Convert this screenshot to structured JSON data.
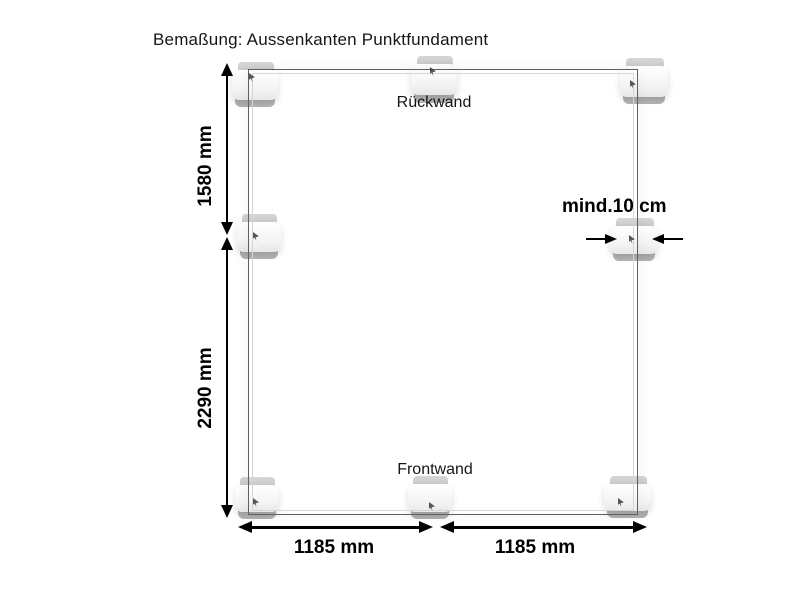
{
  "title": "Bemaßung: Aussenkanten Punktfundament",
  "labels": {
    "back_wall": "Rückwand",
    "front_wall": "Frontwand"
  },
  "dimensions": {
    "depth_upper": "1580 mm",
    "depth_lower": "2290 mm",
    "width_left": "1185 mm",
    "width_right": "1185 mm",
    "block_clearance": "mind.10 cm"
  },
  "diagram": {
    "type": "foundation-plan",
    "foundation_block_count": 8,
    "values_mm": {
      "depth_upper": 1580,
      "depth_lower": 2290,
      "width_left": 1185,
      "width_right": 1185,
      "minimum_block_clearance_cm": 10
    }
  },
  "colors": {
    "bg": "#ffffff",
    "line_dark": "#5f5f5f",
    "line_light": "#d6d6d6",
    "dim": "#000000",
    "text": "#161616",
    "block_top": "#c9c9c9",
    "block_face": "#f6f6f6",
    "block_base": "#b4b4b4"
  }
}
